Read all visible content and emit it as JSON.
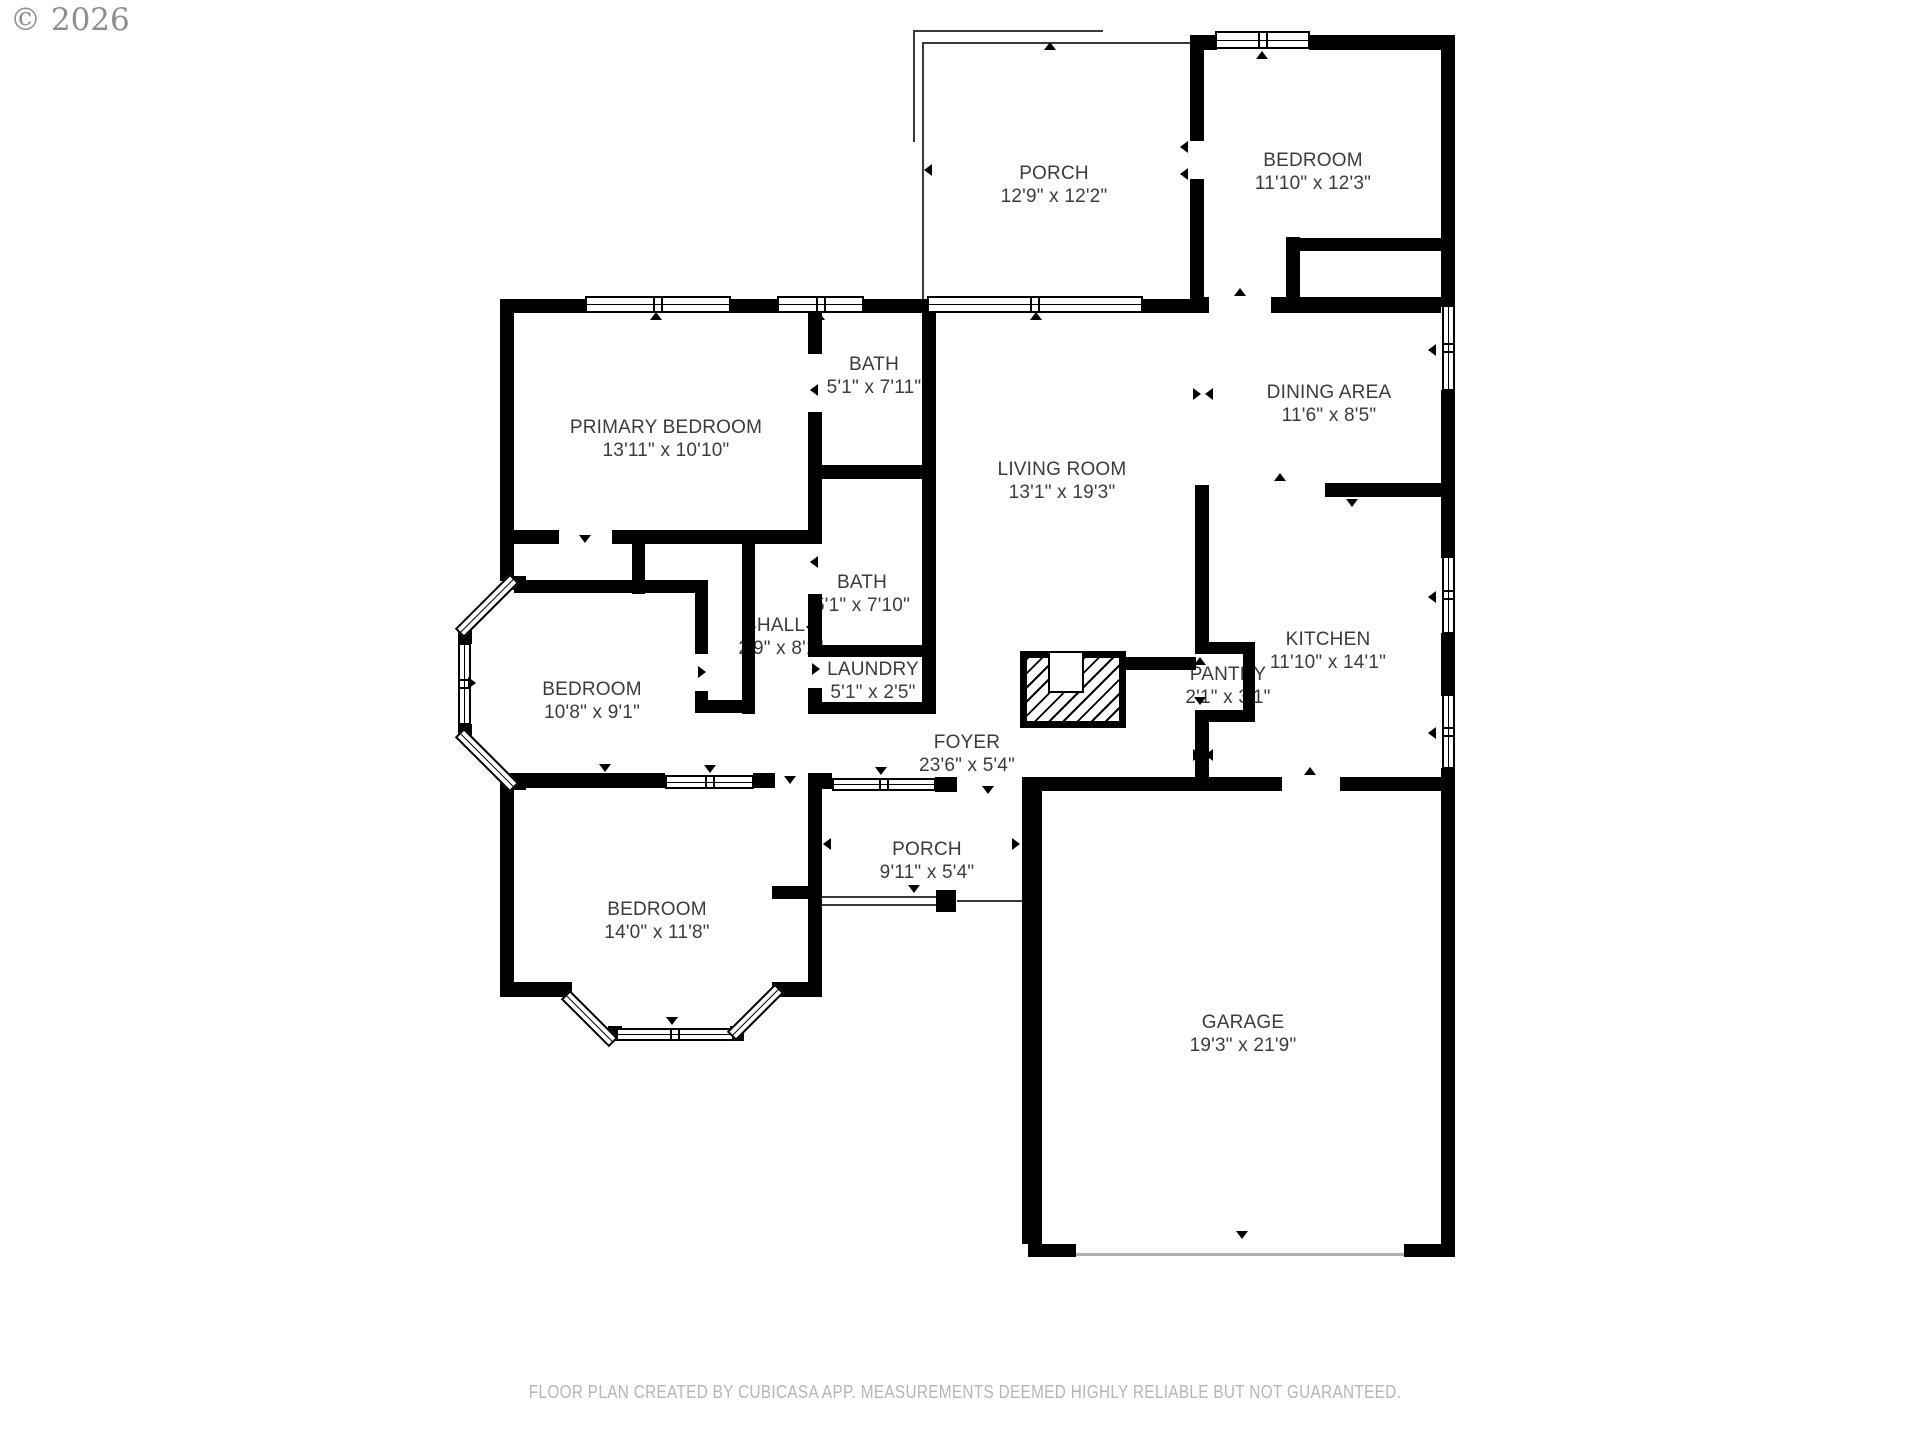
{
  "copyright": "© 2026",
  "footer": "FLOOR PLAN CREATED BY CUBICASA APP. MEASUREMENTS DEEMED HIGHLY RELIABLE BUT NOT GUARANTEED.",
  "colors": {
    "wall": "#000000",
    "label": "#3c3c3c",
    "footer_text": "#b5b5b5",
    "copyright_text": "#8e8e8e"
  },
  "rooms": {
    "porch_top": {
      "label": "PORCH",
      "dim": "12'9\" x 12'2\""
    },
    "bedroom_tr": {
      "label": "BEDROOM",
      "dim": "11'10\" x 12'3\""
    },
    "primary_bedroom": {
      "label": "PRIMARY BEDROOM",
      "dim": "13'11\" x 10'10\""
    },
    "bath_upper": {
      "label": "BATH",
      "dim": "5'1\" x 7'11\""
    },
    "dining_area": {
      "label": "DINING AREA",
      "dim": "11'6\" x 8'5\""
    },
    "living_room": {
      "label": "LIVING ROOM",
      "dim": "13'1\" x 19'3\""
    },
    "bath_lower": {
      "label": "BATH",
      "dim": "5'1\" x 7'10\""
    },
    "hall": {
      "label": "HALL",
      "dim": "2'9\" x 8'1\""
    },
    "laundry": {
      "label": "LAUNDRY",
      "dim": "5'1\" x 2'5\""
    },
    "kitchen": {
      "label": "KITCHEN",
      "dim": "11'10\" x 14'1\""
    },
    "pantry": {
      "label": "PANTRY",
      "dim": "2'1\" x 3'1\""
    },
    "bedroom_mid": {
      "label": "BEDROOM",
      "dim": "10'8\" x 9'1\""
    },
    "foyer": {
      "label": "FOYER",
      "dim": "23'6\" x 5'4\""
    },
    "porch_bottom": {
      "label": "PORCH",
      "dim": "9'11\" x 5'4\""
    },
    "bedroom_bottom": {
      "label": "BEDROOM",
      "dim": "14'0\" x 11'8\""
    },
    "garage": {
      "label": "GARAGE",
      "dim": "19'3\" x 21'9\""
    }
  }
}
